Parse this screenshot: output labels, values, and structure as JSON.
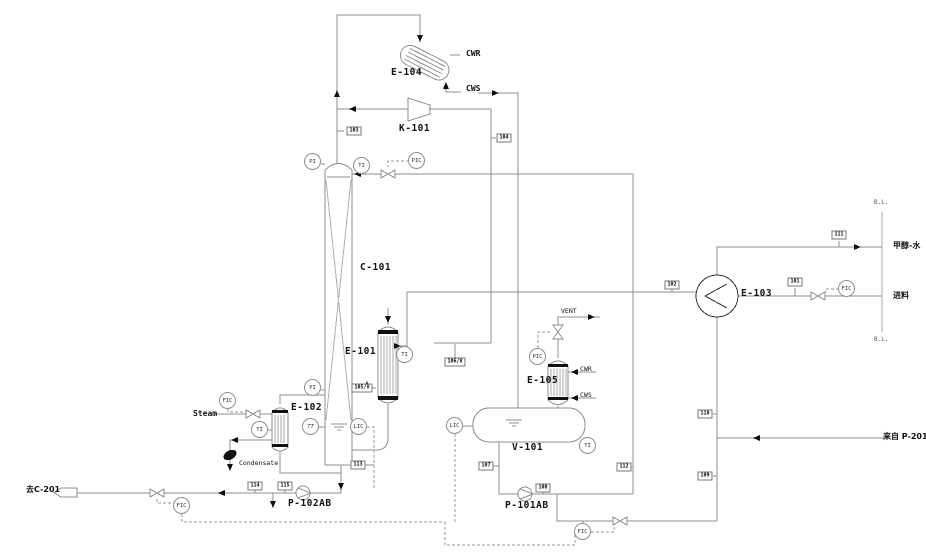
{
  "diagram": {
    "title": "Methanol distillation unit P&ID",
    "colors": {
      "line": "#8f8f8f",
      "text": "#111111",
      "background": "#ffffff",
      "arrow": "#111111"
    },
    "equipment": {
      "e104": "E-104",
      "k101": "K-101",
      "c101": "C-101",
      "e101": "E-101",
      "e102": "E-102",
      "e103": "E-103",
      "e105": "E-105",
      "v101": "V-101",
      "p101ab": "P-101AB",
      "p102ab": "P-102AB"
    },
    "streams": {
      "cwr_top": "CWR",
      "cws_top": "CWS",
      "cwr_e105": "CWR",
      "cws_e105": "CWS",
      "steam": "Steam",
      "condensate": "Condensate",
      "vent": "VENT",
      "to_c201": "去C-201",
      "from_p201ab": "来自 P-201A/B",
      "product": "甲醇-水",
      "feed": "进料",
      "bl_top": "B.L.",
      "bl_bot": "B.L."
    },
    "instruments": [
      {
        "tag": "PI",
        "x": 313,
        "y": 162
      },
      {
        "tag": "TI",
        "x": 362,
        "y": 166
      },
      {
        "tag": "PIC",
        "x": 417,
        "y": 161
      },
      {
        "tag": "TI",
        "x": 405,
        "y": 355
      },
      {
        "tag": "FIC",
        "x": 228,
        "y": 401
      },
      {
        "tag": "TI",
        "x": 260,
        "y": 430
      },
      {
        "tag": "PI",
        "x": 313,
        "y": 388
      },
      {
        "tag": "TT",
        "x": 311,
        "y": 427
      },
      {
        "tag": "LIC",
        "x": 359,
        "y": 427
      },
      {
        "tag": "FIC",
        "x": 182,
        "y": 506
      },
      {
        "tag": "LIC",
        "x": 455,
        "y": 426
      },
      {
        "tag": "TI",
        "x": 588,
        "y": 446
      },
      {
        "tag": "PIC",
        "x": 538,
        "y": 357
      },
      {
        "tag": "FIC",
        "x": 583,
        "y": 532
      },
      {
        "tag": "FIC",
        "x": 847,
        "y": 289
      }
    ],
    "flags": [
      {
        "no": "103",
        "x": 354,
        "y": 131
      },
      {
        "no": "104",
        "x": 504,
        "y": 138
      },
      {
        "no": "105/V",
        "x": 362,
        "y": 388
      },
      {
        "no": "106/V",
        "x": 455,
        "y": 362
      },
      {
        "no": "102",
        "x": 672,
        "y": 285
      },
      {
        "no": "101",
        "x": 795,
        "y": 282
      },
      {
        "no": "111",
        "x": 839,
        "y": 235
      },
      {
        "no": "110",
        "x": 705,
        "y": 414
      },
      {
        "no": "109",
        "x": 705,
        "y": 476
      },
      {
        "no": "107",
        "x": 486,
        "y": 466
      },
      {
        "no": "108",
        "x": 543,
        "y": 488
      },
      {
        "no": "112",
        "x": 624,
        "y": 467
      },
      {
        "no": "113",
        "x": 358,
        "y": 465
      },
      {
        "no": "114",
        "x": 255,
        "y": 486
      },
      {
        "no": "115",
        "x": 285,
        "y": 486
      }
    ]
  }
}
